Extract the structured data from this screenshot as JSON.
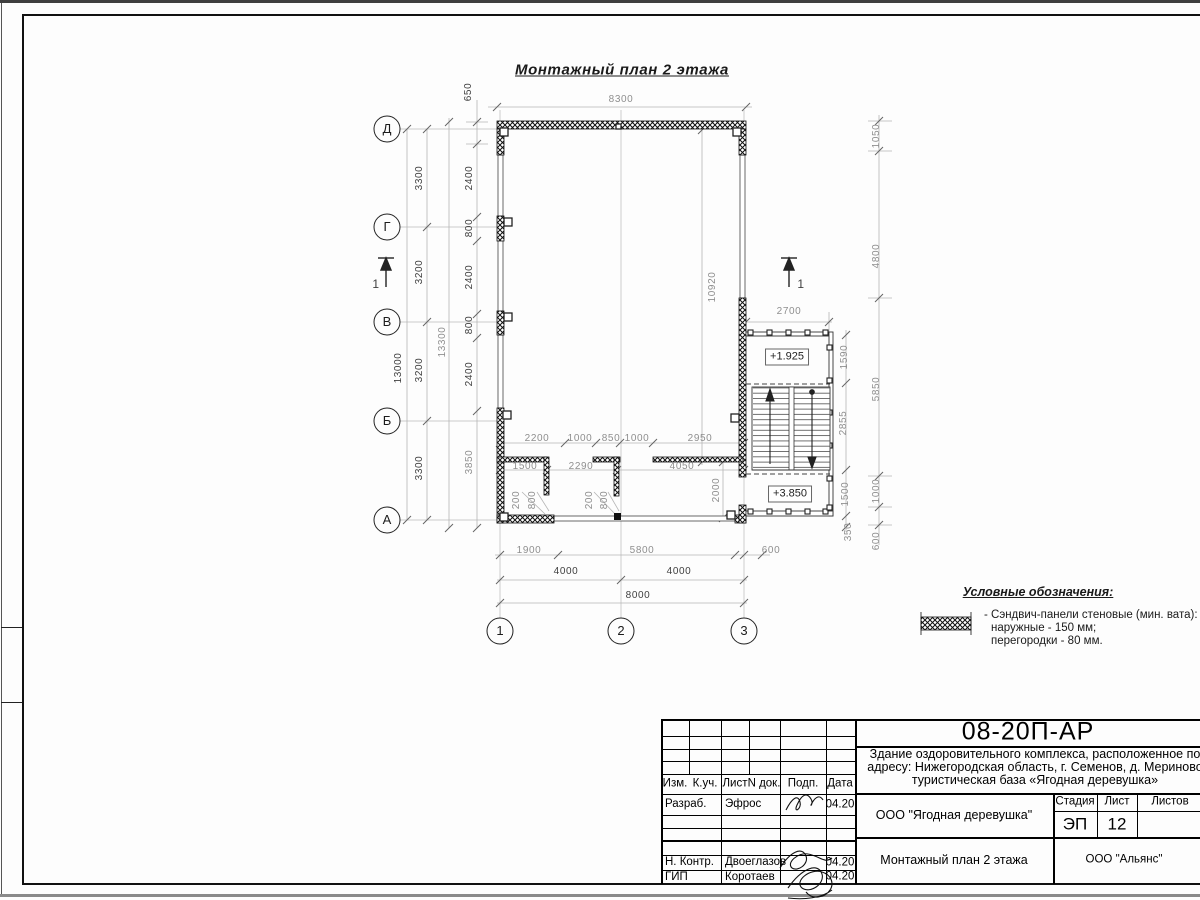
{
  "drawing_title": "Монтажный план 2 этажа",
  "plan": {
    "axes_left": [
      {
        "label": "Д",
        "x": 387,
        "y": 129
      },
      {
        "label": "Г",
        "x": 387,
        "y": 227
      },
      {
        "label": "В",
        "x": 387,
        "y": 322
      },
      {
        "label": "Б",
        "x": 387,
        "y": 421
      },
      {
        "label": "А",
        "x": 387,
        "y": 520
      }
    ],
    "axes_bottom": [
      {
        "label": "1",
        "x": 500,
        "y": 631
      },
      {
        "label": "2",
        "x": 621,
        "y": 631
      },
      {
        "label": "3",
        "x": 744,
        "y": 631
      }
    ],
    "section_mark_label": "1",
    "elevations": {
      "upper": "+1.925",
      "lower": "+3.850"
    },
    "dim_labels": [
      {
        "t": "8300",
        "x": 621,
        "y": 100,
        "rot": false,
        "dark": false
      },
      {
        "t": "650",
        "x": 469,
        "y": 92,
        "rot": true,
        "dark": true
      },
      {
        "t": "2400",
        "x": 470,
        "y": 178,
        "rot": true,
        "dark": true
      },
      {
        "t": "800",
        "x": 470,
        "y": 228,
        "rot": true,
        "dark": true
      },
      {
        "t": "2400",
        "x": 470,
        "y": 277,
        "rot": true,
        "dark": true
      },
      {
        "t": "800",
        "x": 470,
        "y": 325,
        "rot": true,
        "dark": true
      },
      {
        "t": "2400",
        "x": 470,
        "y": 374,
        "rot": true,
        "dark": true
      },
      {
        "t": "3850",
        "x": 470,
        "y": 462,
        "rot": true,
        "dark": false
      },
      {
        "t": "13300",
        "x": 443,
        "y": 342,
        "rot": true,
        "dark": false
      },
      {
        "t": "3300",
        "x": 420,
        "y": 178,
        "rot": true,
        "dark": true
      },
      {
        "t": "3200",
        "x": 420,
        "y": 272,
        "rot": true,
        "dark": true
      },
      {
        "t": "3200",
        "x": 420,
        "y": 370,
        "rot": true,
        "dark": true
      },
      {
        "t": "3300",
        "x": 420,
        "y": 468,
        "rot": true,
        "dark": true
      },
      {
        "t": "13000",
        "x": 399,
        "y": 368,
        "rot": true,
        "dark": true
      },
      {
        "t": "10920",
        "x": 713,
        "y": 287,
        "rot": true,
        "dark": false
      },
      {
        "t": "2200",
        "x": 537,
        "y": 439,
        "rot": false,
        "dark": false
      },
      {
        "t": "1000",
        "x": 580,
        "y": 439,
        "rot": false,
        "dark": false
      },
      {
        "t": "850",
        "x": 611,
        "y": 439,
        "rot": false,
        "dark": false
      },
      {
        "t": "1000",
        "x": 637,
        "y": 439,
        "rot": false,
        "dark": false
      },
      {
        "t": "2950",
        "x": 700,
        "y": 439,
        "rot": false,
        "dark": false
      },
      {
        "t": "1500",
        "x": 525,
        "y": 467,
        "rot": false,
        "dark": false
      },
      {
        "t": "2290",
        "x": 581,
        "y": 467,
        "rot": false,
        "dark": false
      },
      {
        "t": "4050",
        "x": 682,
        "y": 467,
        "rot": false,
        "dark": false
      },
      {
        "t": "200",
        "x": 517,
        "y": 500,
        "rot": true,
        "dark": false
      },
      {
        "t": "800",
        "x": 533,
        "y": 500,
        "rot": true,
        "dark": false
      },
      {
        "t": "200",
        "x": 590,
        "y": 500,
        "rot": true,
        "dark": false
      },
      {
        "t": "800",
        "x": 605,
        "y": 500,
        "rot": true,
        "dark": false
      },
      {
        "t": "2000",
        "x": 717,
        "y": 490,
        "rot": true,
        "dark": false
      },
      {
        "t": "1900",
        "x": 529,
        "y": 551,
        "rot": false,
        "dark": false
      },
      {
        "t": "5800",
        "x": 642,
        "y": 551,
        "rot": false,
        "dark": false
      },
      {
        "t": "600",
        "x": 771,
        "y": 551,
        "rot": false,
        "dark": false
      },
      {
        "t": "4000",
        "x": 566,
        "y": 572,
        "rot": false,
        "dark": true
      },
      {
        "t": "4000",
        "x": 679,
        "y": 572,
        "rot": false,
        "dark": true
      },
      {
        "t": "8000",
        "x": 638,
        "y": 596,
        "rot": false,
        "dark": true
      },
      {
        "t": "2700",
        "x": 789,
        "y": 312,
        "rot": false,
        "dark": false
      },
      {
        "t": "1590",
        "x": 845,
        "y": 357,
        "rot": true,
        "dark": false
      },
      {
        "t": "2855",
        "x": 844,
        "y": 423,
        "rot": true,
        "dark": false
      },
      {
        "t": "1500",
        "x": 846,
        "y": 494,
        "rot": true,
        "dark": false
      },
      {
        "t": "350",
        "x": 849,
        "y": 532,
        "rot": true,
        "dark": false
      },
      {
        "t": "1050",
        "x": 877,
        "y": 136,
        "rot": true,
        "dark": false
      },
      {
        "t": "4800",
        "x": 877,
        "y": 256,
        "rot": true,
        "dark": false
      },
      {
        "t": "5850",
        "x": 877,
        "y": 389,
        "rot": true,
        "dark": false
      },
      {
        "t": "1000",
        "x": 877,
        "y": 491,
        "rot": true,
        "dark": false
      },
      {
        "t": "600",
        "x": 877,
        "y": 541,
        "rot": true,
        "dark": false
      }
    ]
  },
  "legend": {
    "header": "Условные обозначения:",
    "item": "- Сэндвич-панели стеновые (мин. вата):",
    "item_line2": "наружные - 150 мм;",
    "item_line3": "перегородки - 80 мм."
  },
  "title_block": {
    "doc_code": "08-20П-АР",
    "project_line1": "Здание оздоровительного комплекса, расположенное по",
    "project_line2": "адресу: Нижегородская область, г. Семенов, д. Мериново",
    "project_line3": "туристическая база «Ягодная деревушка»",
    "col_izm": "Изм.",
    "col_kuch": "К.уч.",
    "col_list": "Лист",
    "col_ndok": "N док.",
    "col_podp": "Подп.",
    "col_data": "Дата",
    "row1_role": "Разраб.",
    "row1_name": "Эфрос",
    "row1_date": "04.20",
    "row2_role": "Н. Контр.",
    "row2_name": "Двоеглазов",
    "row2_date": "04.20",
    "row3_role": "ГИП",
    "row3_name": "Коротаев",
    "row3_date": "04.20",
    "org": "ООО \"Ягодная деревушка\"",
    "sheet_title": "Монтажный план 2 этажа",
    "contractor": "ООО \"Альянс\"",
    "stage_label": "Стадия",
    "stage_value": "ЭП",
    "list_label": "Лист",
    "list_value": "12",
    "listov_label": "Листов"
  }
}
